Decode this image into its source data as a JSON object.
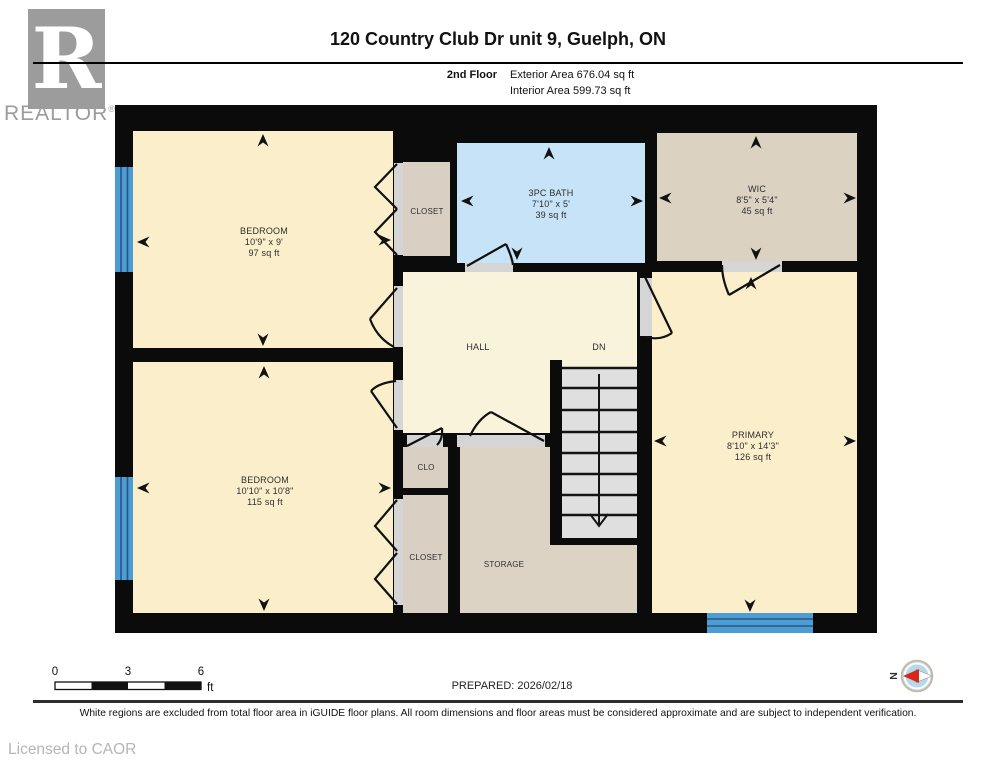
{
  "header": {
    "logo_letter": "R",
    "logo_text": "REALTOR",
    "logo_reg": "®",
    "title": "120 Country Club Dr unit 9, Guelph, ON",
    "floor_label": "2nd Floor",
    "exterior_area": "Exterior Area 676.04 sq ft",
    "interior_area": "Interior Area 599.73 sq ft"
  },
  "rooms": {
    "bedroom1": {
      "name": "BEDROOM",
      "dims": "10'9\" x 9'",
      "area": "97 sq ft"
    },
    "closet_top": {
      "name": "CLOSET"
    },
    "bath": {
      "name": "3PC BATH",
      "dims": "7'10\" x 5'",
      "area": "39 sq ft"
    },
    "wic": {
      "name": "WIC",
      "dims": "8'5\" x 5'4\"",
      "area": "45 sq ft"
    },
    "hall": {
      "name": "HALL"
    },
    "stairs": {
      "label": "DN"
    },
    "bedroom2": {
      "name": "BEDROOM",
      "dims": "10'10\" x 10'8\"",
      "area": "115 sq ft"
    },
    "clo": {
      "name": "CLO"
    },
    "closet_bottom": {
      "name": "CLOSET"
    },
    "storage": {
      "name": "STORAGE"
    },
    "primary": {
      "name": "PRIMARY",
      "dims": "8'10\" x 14'3\"",
      "area": "126 sq ft"
    }
  },
  "footer": {
    "scale": {
      "t0": "0",
      "t3": "3",
      "t6": "6",
      "unit": "ft"
    },
    "prepared": "PREPARED: 2026/02/18",
    "compass_label": "N",
    "disclaimer": "White regions are excluded from total floor area in iGUIDE floor plans. All room dimensions and floor areas must be considered approximate and are subject to independent verification.",
    "license": "Licensed to CAOR"
  },
  "colors": {
    "wall": "#0b0b0b",
    "room_cream": "#FAEECB",
    "hall_cream": "#FAF3DC",
    "closet_tan": "#D9D0C3",
    "wic_tan": "#DBD2C2",
    "bath_blue": "#C6E3F7",
    "window_blue": "#4E9CD4",
    "stair_grey": "#DFDFDF",
    "opening_grey": "#D5D5D5",
    "compass_red": "#D62718"
  }
}
